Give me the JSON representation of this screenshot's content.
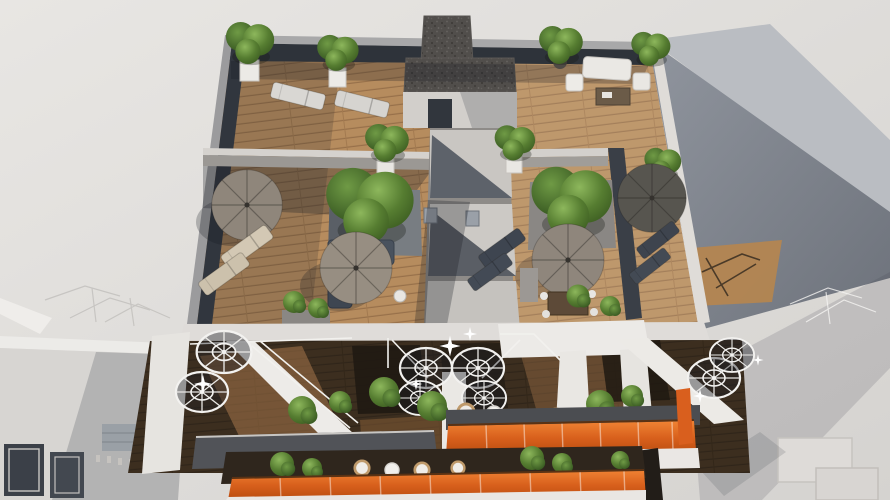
{
  "image": {
    "kind": "3d architectural rendering",
    "view": "aerial top-down, late-afternoon sun from the right",
    "subject": "apartment building rooftop with two wooden-deck terraces divided by light-grey walls, central stair bulkhead with gravel roof, parasols, sun loungers, lounge sofas and potted trees; attic-level terraces below with white spiral staircases; two lower balcony levels with orange glass railings and wicker furniture; neighbouring light-grey buildings with TV antennas on both sides"
  },
  "palette": {
    "background": "#e3e1de",
    "neighbor_shadow_wall": "#868b94",
    "wall_sunlit": "#d7d4d0",
    "wall_shaded": "#383d46",
    "deck_wood": "#b68c5e",
    "deck_wood_shaded": "#3c2e1f",
    "gravel_roof": "#4e4b48",
    "foliage": "#567d31",
    "parasol_taupe": "#8f867b",
    "parasol_dark": "#57554f",
    "sofa_navy": "#49525e",
    "white_furniture": "#eceae6",
    "orange_railing": "#d8601c",
    "stair_white": "#f3f2f0"
  },
  "inventory": {
    "rooftop_parasols": 4,
    "sun_loungers": 8,
    "outdoor_sofa_sets": 2,
    "dining_tables": 2,
    "potted_trees_and_shrubs": "20+",
    "spiral_staircases": 3,
    "stair_bulkheads_with_gravel_roof": 1,
    "balcony_levels_with_orange_glass_railing": 2,
    "neighboring_buildings": 2,
    "tv_antennas": "multiple"
  }
}
